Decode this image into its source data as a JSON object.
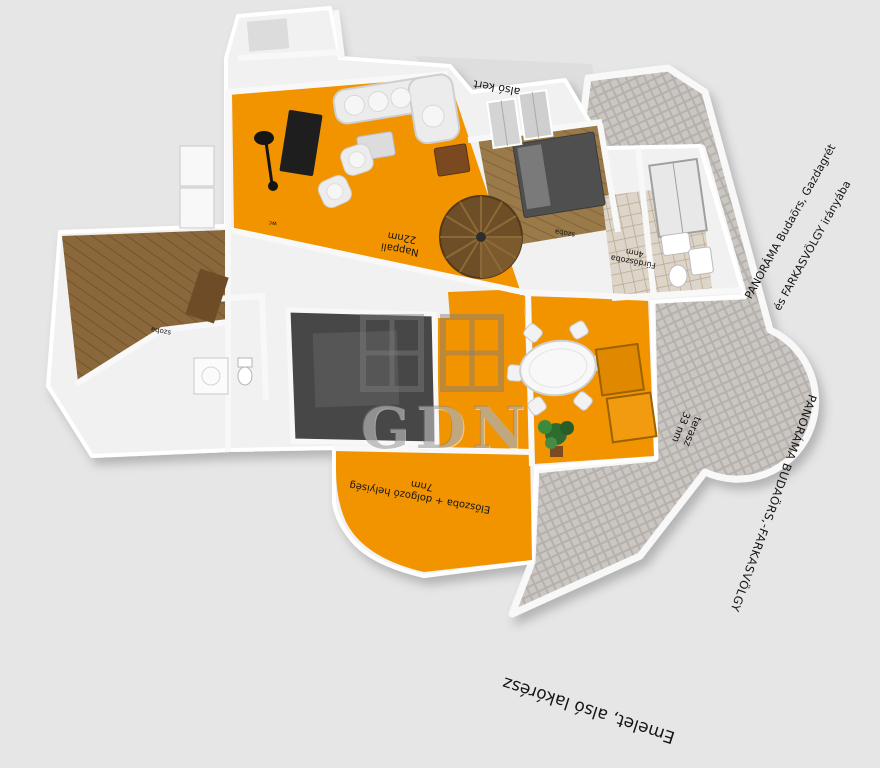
{
  "scene": {
    "title": "Emelet, alsó lakórész",
    "garden_label": "alsó kert",
    "panorama_top": {
      "line1": "PANORÁMA Budaörs, Gazdagrét",
      "line2": "és FARKASVÖLGY irányába"
    },
    "panorama_side": "PANORÁMA BUDAÖRS,-FARKASVÖLGY",
    "watermark": "GDN",
    "rooms": {
      "nappali": {
        "name": "Nappali",
        "area": "22nm"
      },
      "eloszoba": {
        "name": "Előszoba + dolgozó helyiség",
        "area": "7nm"
      },
      "terasz": {
        "name": "terasz",
        "area": "33 nm"
      },
      "furdoszoba": {
        "name": "Fürdőszoba",
        "area": "4nm"
      },
      "szoba_felso": {
        "name": "szoba"
      },
      "szoba_bal": {
        "name": "szoba"
      },
      "wc": {
        "name": "wc"
      }
    },
    "colors": {
      "floor_orange": "#F29400",
      "wall_white": "#F2F2F2",
      "background": "#E6E6E6",
      "wood_brown": "#8A683C",
      "terrace_gray": "#CAC6C2",
      "dark_room": "#474747"
    }
  }
}
